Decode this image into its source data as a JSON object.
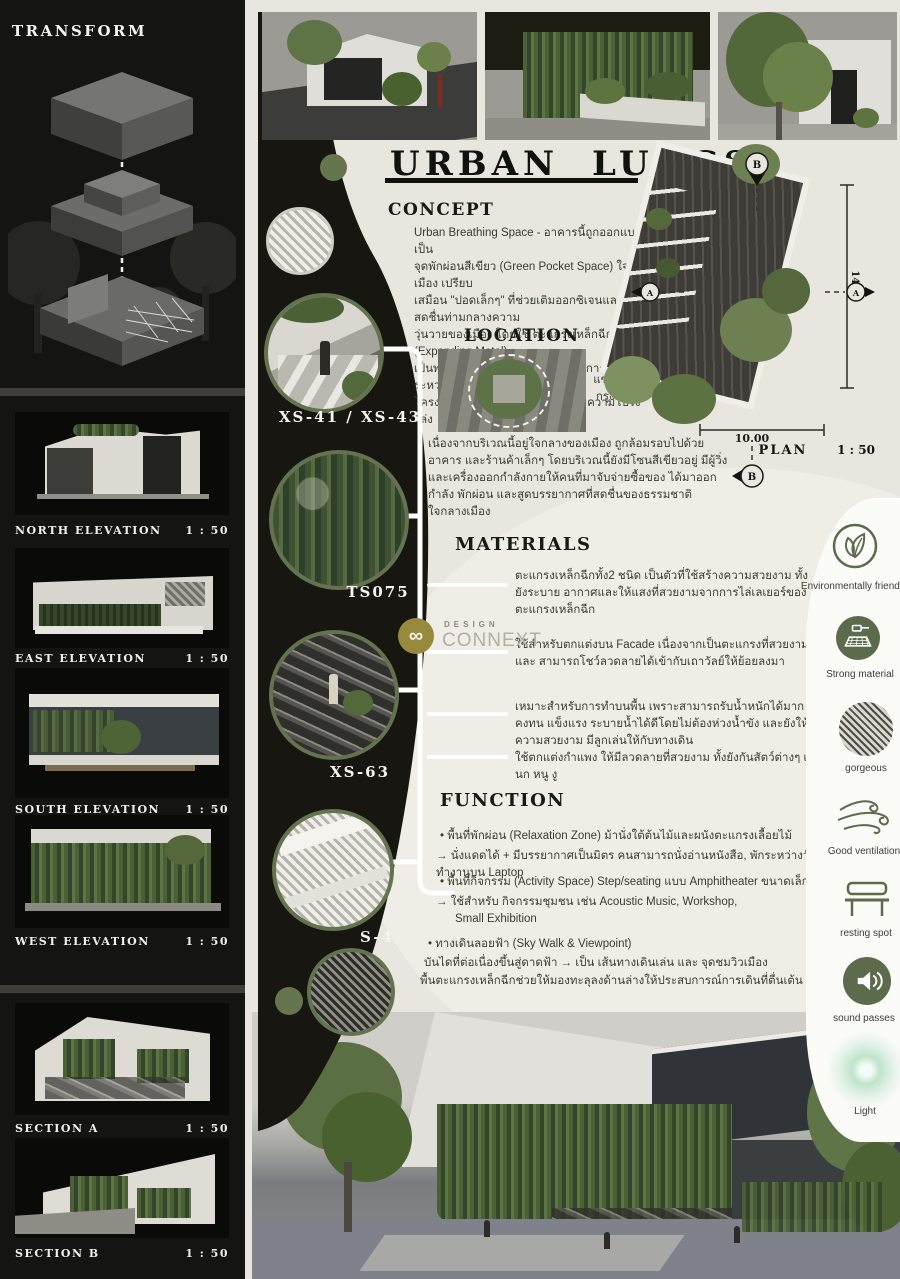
{
  "title": {
    "text": "URBAN LUNGS"
  },
  "left_sidebar": {
    "transform_title": "TRANSFORM",
    "panels": [
      {
        "label": "NORTH ELEVATION",
        "scale": "1 : 50"
      },
      {
        "label": "EAST ELEVATION",
        "scale": "1 : 50"
      },
      {
        "label": "SOUTH ELEVATION",
        "scale": "1 : 50"
      },
      {
        "label": "WEST ELEVATION",
        "scale": "1 : 50"
      },
      {
        "label": "SECTION A",
        "scale": "1 : 50"
      },
      {
        "label": "SECTION B",
        "scale": "1 : 50"
      }
    ]
  },
  "concept": {
    "heading": "CONCEPT",
    "lines": [
      "Urban Breathing Space - อาคารนี้ถูกออกแบบให้เป็น",
      "จุดพักผ่อนสีเขียว (Green Pocket Space) ใจกลางเมือง เปรียบ",
      "เสมือน \"ปอดเล็กๆ\" ที่ช่วยเติมออกซิเจนและความสดชื่นท่ามกลางความ",
      "วุ่นวายของเมือง โดยใช้ ตะแกรงเหล็กฉีก (Expanding Metal)",
      "เป็นพระเอกหลักของงาน เพื่อให้เกิดการสานต่อระหว่าง",
      "โครงสร้างแข็งแรง พื้นที่สีเขียว และความโปร่งโล่ง"
    ]
  },
  "location": {
    "heading": "LOCATION",
    "address_line1": "แขวงดินแดง เขตดินแดง",
    "address_line2": "กรุงเทพมหานคร 10400",
    "description": "เนื่องจากบริเวณนี้อยู่ใจกลางของเมือง ถูกล้อมรอบไปด้วยอาคาร และร้านค้าเล็กๆ โดยบริเวณนี้ยังมีโซนสีเขียวอยู่ มีผู้วิ่ง และเครื่องออกกำลังกายให้คนที่มาจับจ่ายซื้อของ ได้มาออกกำลัง พักผ่อน และสูดบรรยากาศที่สดชื่นของธรรมชาติใจกลางเมือง"
  },
  "plan": {
    "label": "PLAN",
    "scale": "1 : 50",
    "dim_height": "14.00",
    "dim_width": "10.00",
    "marker_a": "A",
    "marker_b": "B"
  },
  "materials": {
    "heading": "MATERIALS",
    "items": [
      "ตะแกรงเหล็กฉีกทั้ง2 ชนิด เป็นตัวที่ใช้สร้างความสวยงาม ทั้งยังระบาย อากาศและให้แสงที่สวยงามจากการไล่เลเยอร์ของตะแกรงเหล็กฉีก",
      "ใช้สำหรับตกแต่งบน Facade เนื่องจากเป็นตะแกรงที่สวยงาม และ สามารถโชว์ลวดลายได้เข้ากับเถาวัลย์ให้ย้อยลงมา",
      "เหมาะสำหรับการทำบนพื้น เพราะสามารถรับน้ำหนักได้มาก คงทน แข็งแรง ระบายน้ำได้ดีโดยไม่ต้องห่วงน้ำขัง และยังให้ความสวยงาม มีลูกเล่นให้กับทางเดิน",
      "ใช้ตกแต่งกำแพง ให้มีลวดลายที่สวยงาม ทั้งยังกันสัตว์ต่างๆ เช่น นก หนู งู"
    ]
  },
  "function": {
    "heading": "FUNCTION",
    "lines": [
      "•  พื้นที่พักผ่อน (Relaxation Zone) ม้านั่งใต้ต้นไม้และผนังตะแกรงเลื้อยไม้",
      "→  นั่งแดดได้ + มีบรรยากาศเป็นมิตร คนสามารถนั่งอ่านหนังสือ, พักระหว่างวัน, ทำงานบน Laptop",
      "•  พื้นที่กิจกรรม (Activity Space) Step/seating แบบ Amphitheater ขนาดเล็ก",
      "→  ใช้สำหรับ กิจกรรมชุมชน เช่น Acoustic Music, Workshop,",
      "Small Exhibition",
      "•  ทางเดินลอยฟ้า (Sky Walk & Viewpoint)",
      "บันไดที่ต่อเนื่องขึ้นสู่ดาดฟ้า → เป็น เส้นทางเดินเล่น และ จุดชมวิวเมือง",
      "พื้นตะแกรงเหล็กฉีกช่วยให้มองทะลุลงด้านล่างให้ประสบการณ์การเดินที่ตื่นเต้น"
    ]
  },
  "detail_circles": {
    "c1": "XS-41 / XS-43",
    "c2": "TS075",
    "c3": "XS-63",
    "c4": "S-4"
  },
  "benefits": [
    {
      "icon": "leaf-icon",
      "label": "Environmentally friendly"
    },
    {
      "icon": "hammer-mesh-icon",
      "label": "Strong material"
    },
    {
      "icon": "mesh-texture-icon",
      "label": "gorgeous"
    },
    {
      "icon": "wind-icon",
      "label": "Good ventilation"
    },
    {
      "icon": "bench-icon",
      "label": "resting spot"
    },
    {
      "icon": "speaker-icon",
      "label": "sound passes"
    },
    {
      "icon": "light-glow-icon",
      "label": "Light"
    }
  ],
  "watermark": {
    "top": "DESIGN",
    "bottom": "CONNEXT"
  },
  "colors": {
    "accent_olive": "#5d6b4d",
    "dark_panel": "#141412",
    "beige": "#e8e6df",
    "white_strip": "#fbfbf8"
  }
}
